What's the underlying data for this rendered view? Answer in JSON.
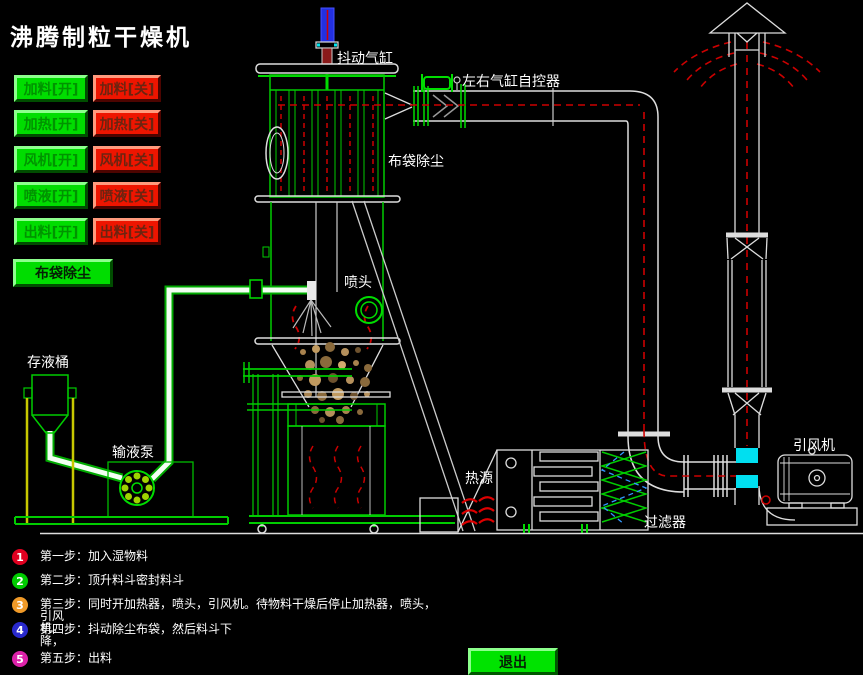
{
  "title": "沸腾制粒干燥机",
  "controls": {
    "pairs": [
      {
        "name": "feed",
        "on": "加料[开]",
        "off": "加料[关]"
      },
      {
        "name": "heat",
        "on": "加热[开]",
        "off": "加热[关]"
      },
      {
        "name": "fan",
        "on": "风机[开]",
        "off": "风机[关]"
      },
      {
        "name": "spray",
        "on": "喷液[开]",
        "off": "喷液[关]"
      },
      {
        "name": "discharge",
        "on": "出料[开]",
        "off": "出料[关]"
      }
    ],
    "bag_clean": "布袋除尘",
    "exit": "退出"
  },
  "diagram": {
    "labels": {
      "shaker": "抖动气缸",
      "cylinder_ctrl": "左右气缸自控器",
      "baghouse": "布袋除尘",
      "nozzle": "喷头",
      "tank": "存液桶",
      "pump": "输液泵",
      "heat_source": "热源",
      "filter": "过滤器",
      "draft_fan": "引风机"
    }
  },
  "steps": [
    {
      "num": "1",
      "color": "#e00020",
      "text": "第一步：加入湿物料"
    },
    {
      "num": "2",
      "color": "#00cc00",
      "text": "第二步：顶升料斗密封料斗"
    },
    {
      "num": "3",
      "color": "#f09a28",
      "text": "第三步：同时开加热器，喷头，引风机。待物料干燥后停止加热器，喷头，引风\n机。"
    },
    {
      "num": "4",
      "color": "#2929cc",
      "text": "第四步：抖动除尘布袋，然后料斗下\n降，"
    },
    {
      "num": "5",
      "color": "#dd22aa",
      "text": "第五步：出料"
    }
  ],
  "colors": {
    "button_on": "#00dd00",
    "button_off": "#ee1500",
    "line_green": "#00cc00",
    "line_white": "#e6e6e6",
    "flow_red": "#cc0000",
    "damper_cyan": "#00dff0",
    "shaker_blue": "#2330e0",
    "legs_yellow": "#c8c800"
  }
}
